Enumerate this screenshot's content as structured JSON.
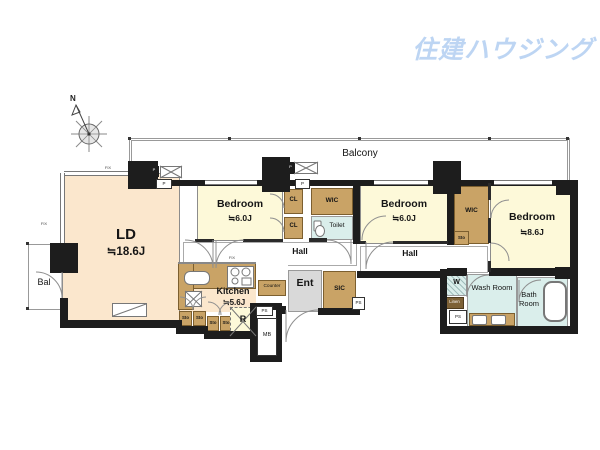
{
  "brand": {
    "logo_text": "住建ハウジング",
    "logo_color": "#bdd5f3"
  },
  "compass": {
    "north_label": "N"
  },
  "balconies": {
    "main_label": "Balcony",
    "side_label": "Bal"
  },
  "rooms": {
    "living_dining": {
      "name": "LD",
      "size": "≒18.6J"
    },
    "kitchen": {
      "name": "Kitchen",
      "size": "≒5.6J"
    },
    "bedroom_west": {
      "name": "Bedroom",
      "size": "≒6.0J"
    },
    "bedroom_center": {
      "name": "Bedroom",
      "size": "≒6.0J"
    },
    "bedroom_east": {
      "name": "Bedroom",
      "size": "≒8.6J"
    },
    "hall_west": {
      "label": "Hall"
    },
    "hall_east": {
      "label": "Hall"
    },
    "entrance": {
      "label": "Ent"
    },
    "toilet": {
      "label": "Toilet"
    },
    "wash_room": {
      "label": "Wash Room"
    },
    "bath_room": {
      "label": "Bath Room"
    }
  },
  "labels": {
    "cl": "CL",
    "wic": "WIC",
    "sic": "SIC",
    "sto": "Sto",
    "linen": "Linen",
    "counter": "Counter",
    "refrigerator": "R",
    "meter_box": "MB",
    "pipe_space": "PS",
    "washer": "W",
    "pipe": "P",
    "fix_window": "FIX"
  },
  "colors": {
    "wall": "#1d1d1d",
    "ld_fill": "#fbe7cd",
    "bedroom_fill": "#fdf9d9",
    "closet_fill": "#c9a366",
    "wet_fill": "#daeeeb",
    "entrance_fill": "#d9d9d9",
    "logo_blue": "#bdd5f3"
  }
}
